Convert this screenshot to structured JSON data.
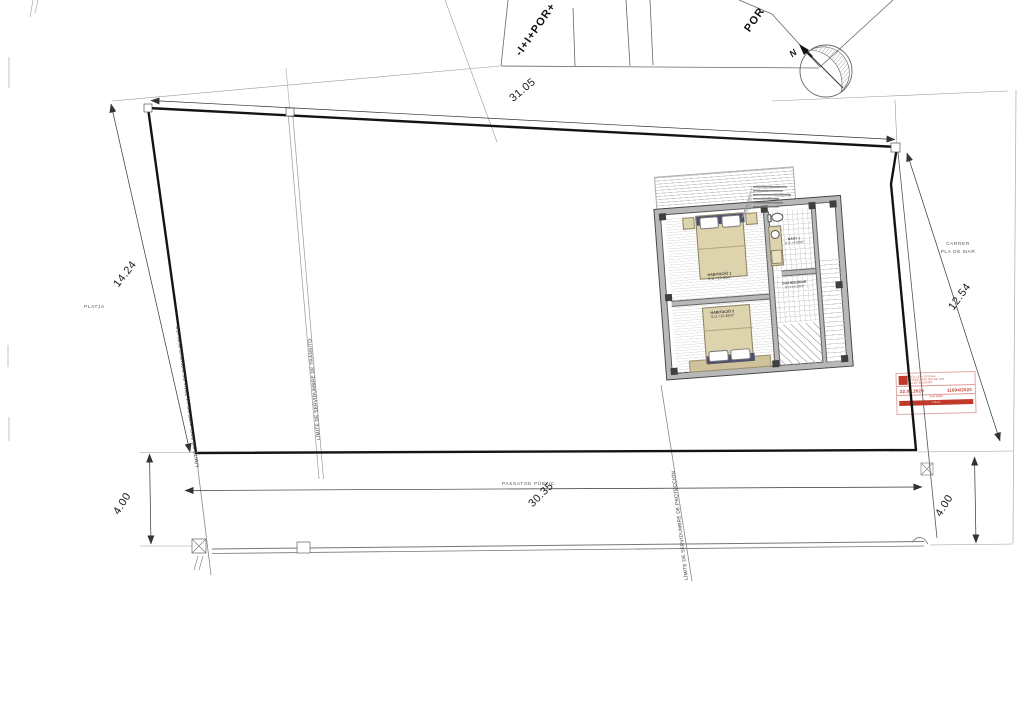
{
  "compass": {
    "north_label": "N"
  },
  "dimensions": {
    "top": "31.05",
    "left": "14.24",
    "right": "12.54",
    "bottom": "30.35",
    "bottom_left": "4.00",
    "bottom_right": "4.00"
  },
  "streets": {
    "platja": "PLATJA",
    "carrer_line1": "CARRER",
    "carrer_line2": "PLA DE MAR",
    "passatge": "PASSATGE PÚBLIC"
  },
  "limits": {
    "deslinde": "LÍMITE DE DESLINDE DE LA ZONA DE DOMINIO PÚBLICO",
    "transito": "LÍMITE DE SERVIDUMBRE DE TRÁNSITO",
    "proteccion": "LÍMITE DE SERVIDUMBRE DE PROTECCIÓN"
  },
  "neighbors": {
    "left_block": "-I+I+POR+",
    "right_block": "POR"
  },
  "rooms": [
    {
      "name": "HABITACIÓ 1",
      "area": "S.U.=10.35m²"
    },
    {
      "name": "BANY 1",
      "area": "S.U.=4.55m²"
    },
    {
      "name": "DISTRIBUÏDOR",
      "area": "S.U.=6.10m²"
    },
    {
      "name": "HABITACIÓ 2",
      "area": "S.U.=10.60m²"
    }
  ],
  "stamp": {
    "org_line1": "COL·LEGI OFICIAL",
    "org_line2": "D'ARQUITECTES DE LES",
    "org_line3": "ILLES BALEARS",
    "date": "22.06.2020",
    "number": "11694/2020",
    "sub": "Visat digital",
    "footer": "VISAT"
  }
}
